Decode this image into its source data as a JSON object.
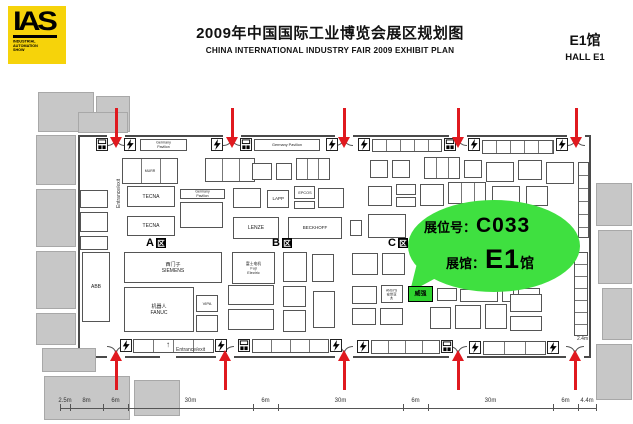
{
  "header": {
    "logo_text": "IAS",
    "logo_sub": "INDUSTRIAL\nAUTOMATION\nSHOW",
    "title_cn": "2009年中国国际工业博览会展区规划图",
    "title_en": "CHINA  INTERNATIONAL  INDUSTRY  FAIR 2009  EXHIBIT PLAN",
    "hall_cn": "E1馆",
    "hall_en": "HALL E1"
  },
  "bubble": {
    "booth_label": "展位号：",
    "booth_no": "C033",
    "hall_label": "展馆：",
    "hall_no": "E1",
    "hall_suffix": "馆"
  },
  "colors": {
    "logo_yellow": "#f6d30a",
    "arrow_red": "#e0191f",
    "bubble_green": "#3fe040",
    "booth_green": "#2fd32f"
  },
  "plan": {
    "zone_glyph": "区",
    "zones": [
      {
        "letter": "A",
        "x": 146,
        "y": 237
      },
      {
        "letter": "B",
        "x": 272,
        "y": 237
      },
      {
        "letter": "C",
        "x": 388,
        "y": 237
      }
    ],
    "entrance_exit_label": "Entrance/exit",
    "side_exit_label": "Entrance/exit",
    "up_glyph": "↑",
    "right_dim_label": "2.4m",
    "arrows_top": [
      116,
      232,
      344,
      458,
      576
    ],
    "arrows_bottom": [
      116,
      225,
      344,
      458,
      575
    ],
    "bolts": [
      {
        "x": 96,
        "y": 138,
        "t": "m"
      },
      {
        "x": 124,
        "y": 138,
        "t": "b"
      },
      {
        "x": 211,
        "y": 138,
        "t": "b"
      },
      {
        "x": 240,
        "y": 138,
        "t": "m"
      },
      {
        "x": 326,
        "y": 138,
        "t": "b"
      },
      {
        "x": 358,
        "y": 138,
        "t": "b"
      },
      {
        "x": 444,
        "y": 138,
        "t": "m"
      },
      {
        "x": 468,
        "y": 138,
        "t": "b"
      },
      {
        "x": 556,
        "y": 138,
        "t": "b"
      },
      {
        "x": 120,
        "y": 339,
        "t": "b"
      },
      {
        "x": 215,
        "y": 339,
        "t": "b"
      },
      {
        "x": 238,
        "y": 339,
        "t": "m"
      },
      {
        "x": 330,
        "y": 339,
        "t": "b"
      },
      {
        "x": 357,
        "y": 340,
        "t": "b"
      },
      {
        "x": 441,
        "y": 340,
        "t": "m"
      },
      {
        "x": 469,
        "y": 341,
        "t": "b"
      },
      {
        "x": 547,
        "y": 341,
        "t": "b"
      }
    ],
    "gray_blocks": [
      [
        38,
        92,
        56,
        40
      ],
      [
        96,
        96,
        34,
        36
      ],
      [
        78,
        112,
        50,
        21
      ],
      [
        36,
        135,
        40,
        50
      ],
      [
        36,
        189,
        40,
        58
      ],
      [
        36,
        251,
        40,
        58
      ],
      [
        36,
        313,
        40,
        32
      ],
      [
        42,
        348,
        54,
        24
      ],
      [
        44,
        376,
        86,
        44
      ],
      [
        134,
        380,
        46,
        36
      ],
      [
        596,
        183,
        36,
        43
      ],
      [
        598,
        230,
        34,
        54
      ],
      [
        602,
        288,
        30,
        52
      ],
      [
        596,
        344,
        36,
        56
      ]
    ],
    "booths": [
      {
        "x": 140,
        "y": 139,
        "w": 47,
        "h": 12,
        "l": "Germany Pavilion",
        "fs": 3.6
      },
      {
        "x": 254,
        "y": 139,
        "w": 66,
        "h": 12,
        "l": "Germany Pavilion",
        "fs": 3.8
      },
      {
        "x": 372,
        "y": 139,
        "w": 70,
        "h": 13,
        "cw": 14
      },
      {
        "x": 482,
        "y": 140,
        "w": 72,
        "h": 14,
        "cw": 14
      },
      {
        "x": 122,
        "y": 158,
        "w": 56,
        "h": 26,
        "l": "MURR",
        "fs": 3.5,
        "cw": 19
      },
      {
        "x": 205,
        "y": 158,
        "w": 50,
        "h": 24,
        "cw": 17
      },
      {
        "x": 252,
        "y": 163,
        "w": 20,
        "h": 17
      },
      {
        "x": 276,
        "y": 163,
        "w": 16,
        "h": 17
      },
      {
        "x": 296,
        "y": 158,
        "w": 34,
        "h": 22,
        "cw": 11
      },
      {
        "x": 370,
        "y": 160,
        "w": 18,
        "h": 18
      },
      {
        "x": 392,
        "y": 160,
        "w": 18,
        "h": 18
      },
      {
        "x": 424,
        "y": 157,
        "w": 36,
        "h": 22,
        "cw": 12
      },
      {
        "x": 464,
        "y": 160,
        "w": 18,
        "h": 18
      },
      {
        "x": 486,
        "y": 162,
        "w": 28,
        "h": 20
      },
      {
        "x": 518,
        "y": 160,
        "w": 24,
        "h": 20
      },
      {
        "x": 546,
        "y": 162,
        "w": 28,
        "h": 22
      },
      {
        "x": 80,
        "y": 190,
        "w": 28,
        "h": 18
      },
      {
        "x": 80,
        "y": 212,
        "w": 28,
        "h": 20
      },
      {
        "x": 80,
        "y": 236,
        "w": 28,
        "h": 14
      },
      {
        "x": 578,
        "y": 162,
        "w": 11,
        "h": 76,
        "ch": 13
      },
      {
        "x": 127,
        "y": 186,
        "w": 48,
        "h": 21,
        "l": "TECNA",
        "fs": 5
      },
      {
        "x": 180,
        "y": 189,
        "w": 45,
        "h": 10,
        "l": "Germany Pavilion",
        "fs": 3.5
      },
      {
        "x": 180,
        "y": 202,
        "w": 43,
        "h": 26
      },
      {
        "x": 233,
        "y": 188,
        "w": 28,
        "h": 20
      },
      {
        "x": 267,
        "y": 190,
        "w": 22,
        "h": 18,
        "l": "LAPP",
        "fs": 4.5
      },
      {
        "x": 294,
        "y": 186,
        "w": 21,
        "h": 13,
        "l": "EPCOS",
        "fs": 3.8
      },
      {
        "x": 294,
        "y": 201,
        "w": 21,
        "h": 8
      },
      {
        "x": 318,
        "y": 188,
        "w": 26,
        "h": 20
      },
      {
        "x": 368,
        "y": 186,
        "w": 24,
        "h": 20
      },
      {
        "x": 396,
        "y": 184,
        "w": 20,
        "h": 11
      },
      {
        "x": 396,
        "y": 197,
        "w": 20,
        "h": 10
      },
      {
        "x": 420,
        "y": 184,
        "w": 24,
        "h": 22
      },
      {
        "x": 448,
        "y": 182,
        "w": 38,
        "h": 22,
        "cw": 13
      },
      {
        "x": 492,
        "y": 186,
        "w": 28,
        "h": 20
      },
      {
        "x": 526,
        "y": 186,
        "w": 22,
        "h": 20
      },
      {
        "x": 127,
        "y": 216,
        "w": 48,
        "h": 20,
        "l": "TECNA",
        "fs": 5
      },
      {
        "x": 233,
        "y": 217,
        "w": 46,
        "h": 22,
        "l": "LENZE",
        "fs": 5
      },
      {
        "x": 288,
        "y": 217,
        "w": 54,
        "h": 22,
        "l": "BECKHOFF",
        "fs": 4.5
      },
      {
        "x": 350,
        "y": 220,
        "w": 12,
        "h": 16
      },
      {
        "x": 368,
        "y": 214,
        "w": 38,
        "h": 24
      },
      {
        "x": 82,
        "y": 252,
        "w": 28,
        "h": 70,
        "l": "ABB",
        "fs": 5
      },
      {
        "x": 124,
        "y": 252,
        "w": 98,
        "h": 31,
        "l": "西门子\nSIEMENS",
        "fs": 5
      },
      {
        "x": 232,
        "y": 252,
        "w": 43,
        "h": 32,
        "l": "富士电机\nFuji Electric",
        "fs": 3.8
      },
      {
        "x": 283,
        "y": 252,
        "w": 24,
        "h": 30
      },
      {
        "x": 312,
        "y": 254,
        "w": 22,
        "h": 28
      },
      {
        "x": 352,
        "y": 253,
        "w": 26,
        "h": 22
      },
      {
        "x": 382,
        "y": 253,
        "w": 23,
        "h": 22
      },
      {
        "x": 124,
        "y": 287,
        "w": 70,
        "h": 45,
        "l": "机器人\nFANUC",
        "fs": 5
      },
      {
        "x": 196,
        "y": 295,
        "w": 22,
        "h": 17,
        "l": "VIPA",
        "fs": 4
      },
      {
        "x": 196,
        "y": 315,
        "w": 22,
        "h": 17
      },
      {
        "x": 228,
        "y": 285,
        "w": 46,
        "h": 20
      },
      {
        "x": 228,
        "y": 309,
        "w": 46,
        "h": 21
      },
      {
        "x": 283,
        "y": 286,
        "w": 23,
        "h": 21
      },
      {
        "x": 283,
        "y": 310,
        "w": 23,
        "h": 22
      },
      {
        "x": 313,
        "y": 291,
        "w": 22,
        "h": 37
      },
      {
        "x": 352,
        "y": 286,
        "w": 25,
        "h": 18
      },
      {
        "x": 381,
        "y": 285,
        "w": 22,
        "h": 18,
        "l": "ANSYS\n安世亚太",
        "fs": 3.3
      },
      {
        "x": 352,
        "y": 308,
        "w": 24,
        "h": 17
      },
      {
        "x": 380,
        "y": 308,
        "w": 23,
        "h": 17
      },
      {
        "x": 408,
        "y": 286,
        "w": 25,
        "h": 16,
        "l": "威强",
        "fs": 6,
        "g": 1
      },
      {
        "x": 437,
        "y": 288,
        "w": 20,
        "h": 13
      },
      {
        "x": 460,
        "y": 289,
        "w": 38,
        "h": 13
      },
      {
        "x": 502,
        "y": 289,
        "w": 12,
        "h": 13
      },
      {
        "x": 518,
        "y": 288,
        "w": 22,
        "h": 14
      },
      {
        "x": 430,
        "y": 307,
        "w": 21,
        "h": 22
      },
      {
        "x": 455,
        "y": 305,
        "w": 26,
        "h": 24
      },
      {
        "x": 485,
        "y": 304,
        "w": 22,
        "h": 25
      },
      {
        "x": 510,
        "y": 294,
        "w": 32,
        "h": 18
      },
      {
        "x": 510,
        "y": 316,
        "w": 32,
        "h": 15
      },
      {
        "x": 574,
        "y": 252,
        "w": 14,
        "h": 84,
        "ch": 12
      },
      {
        "x": 133,
        "y": 339,
        "w": 81,
        "h": 14,
        "cw": 20
      },
      {
        "x": 252,
        "y": 339,
        "w": 77,
        "h": 14,
        "cw": 19
      },
      {
        "x": 371,
        "y": 340,
        "w": 69,
        "h": 14,
        "cw": 17
      },
      {
        "x": 483,
        "y": 341,
        "w": 63,
        "h": 14,
        "cw": 21
      }
    ],
    "dims": {
      "y": 408,
      "boundaries": [
        60,
        70,
        103,
        128,
        253,
        278,
        403,
        428,
        553,
        578,
        596
      ],
      "labels": [
        "2.5m",
        "8m",
        "6m",
        "30m",
        "6m",
        "30m",
        "6m",
        "30m",
        "6m",
        "4.4m"
      ]
    }
  }
}
